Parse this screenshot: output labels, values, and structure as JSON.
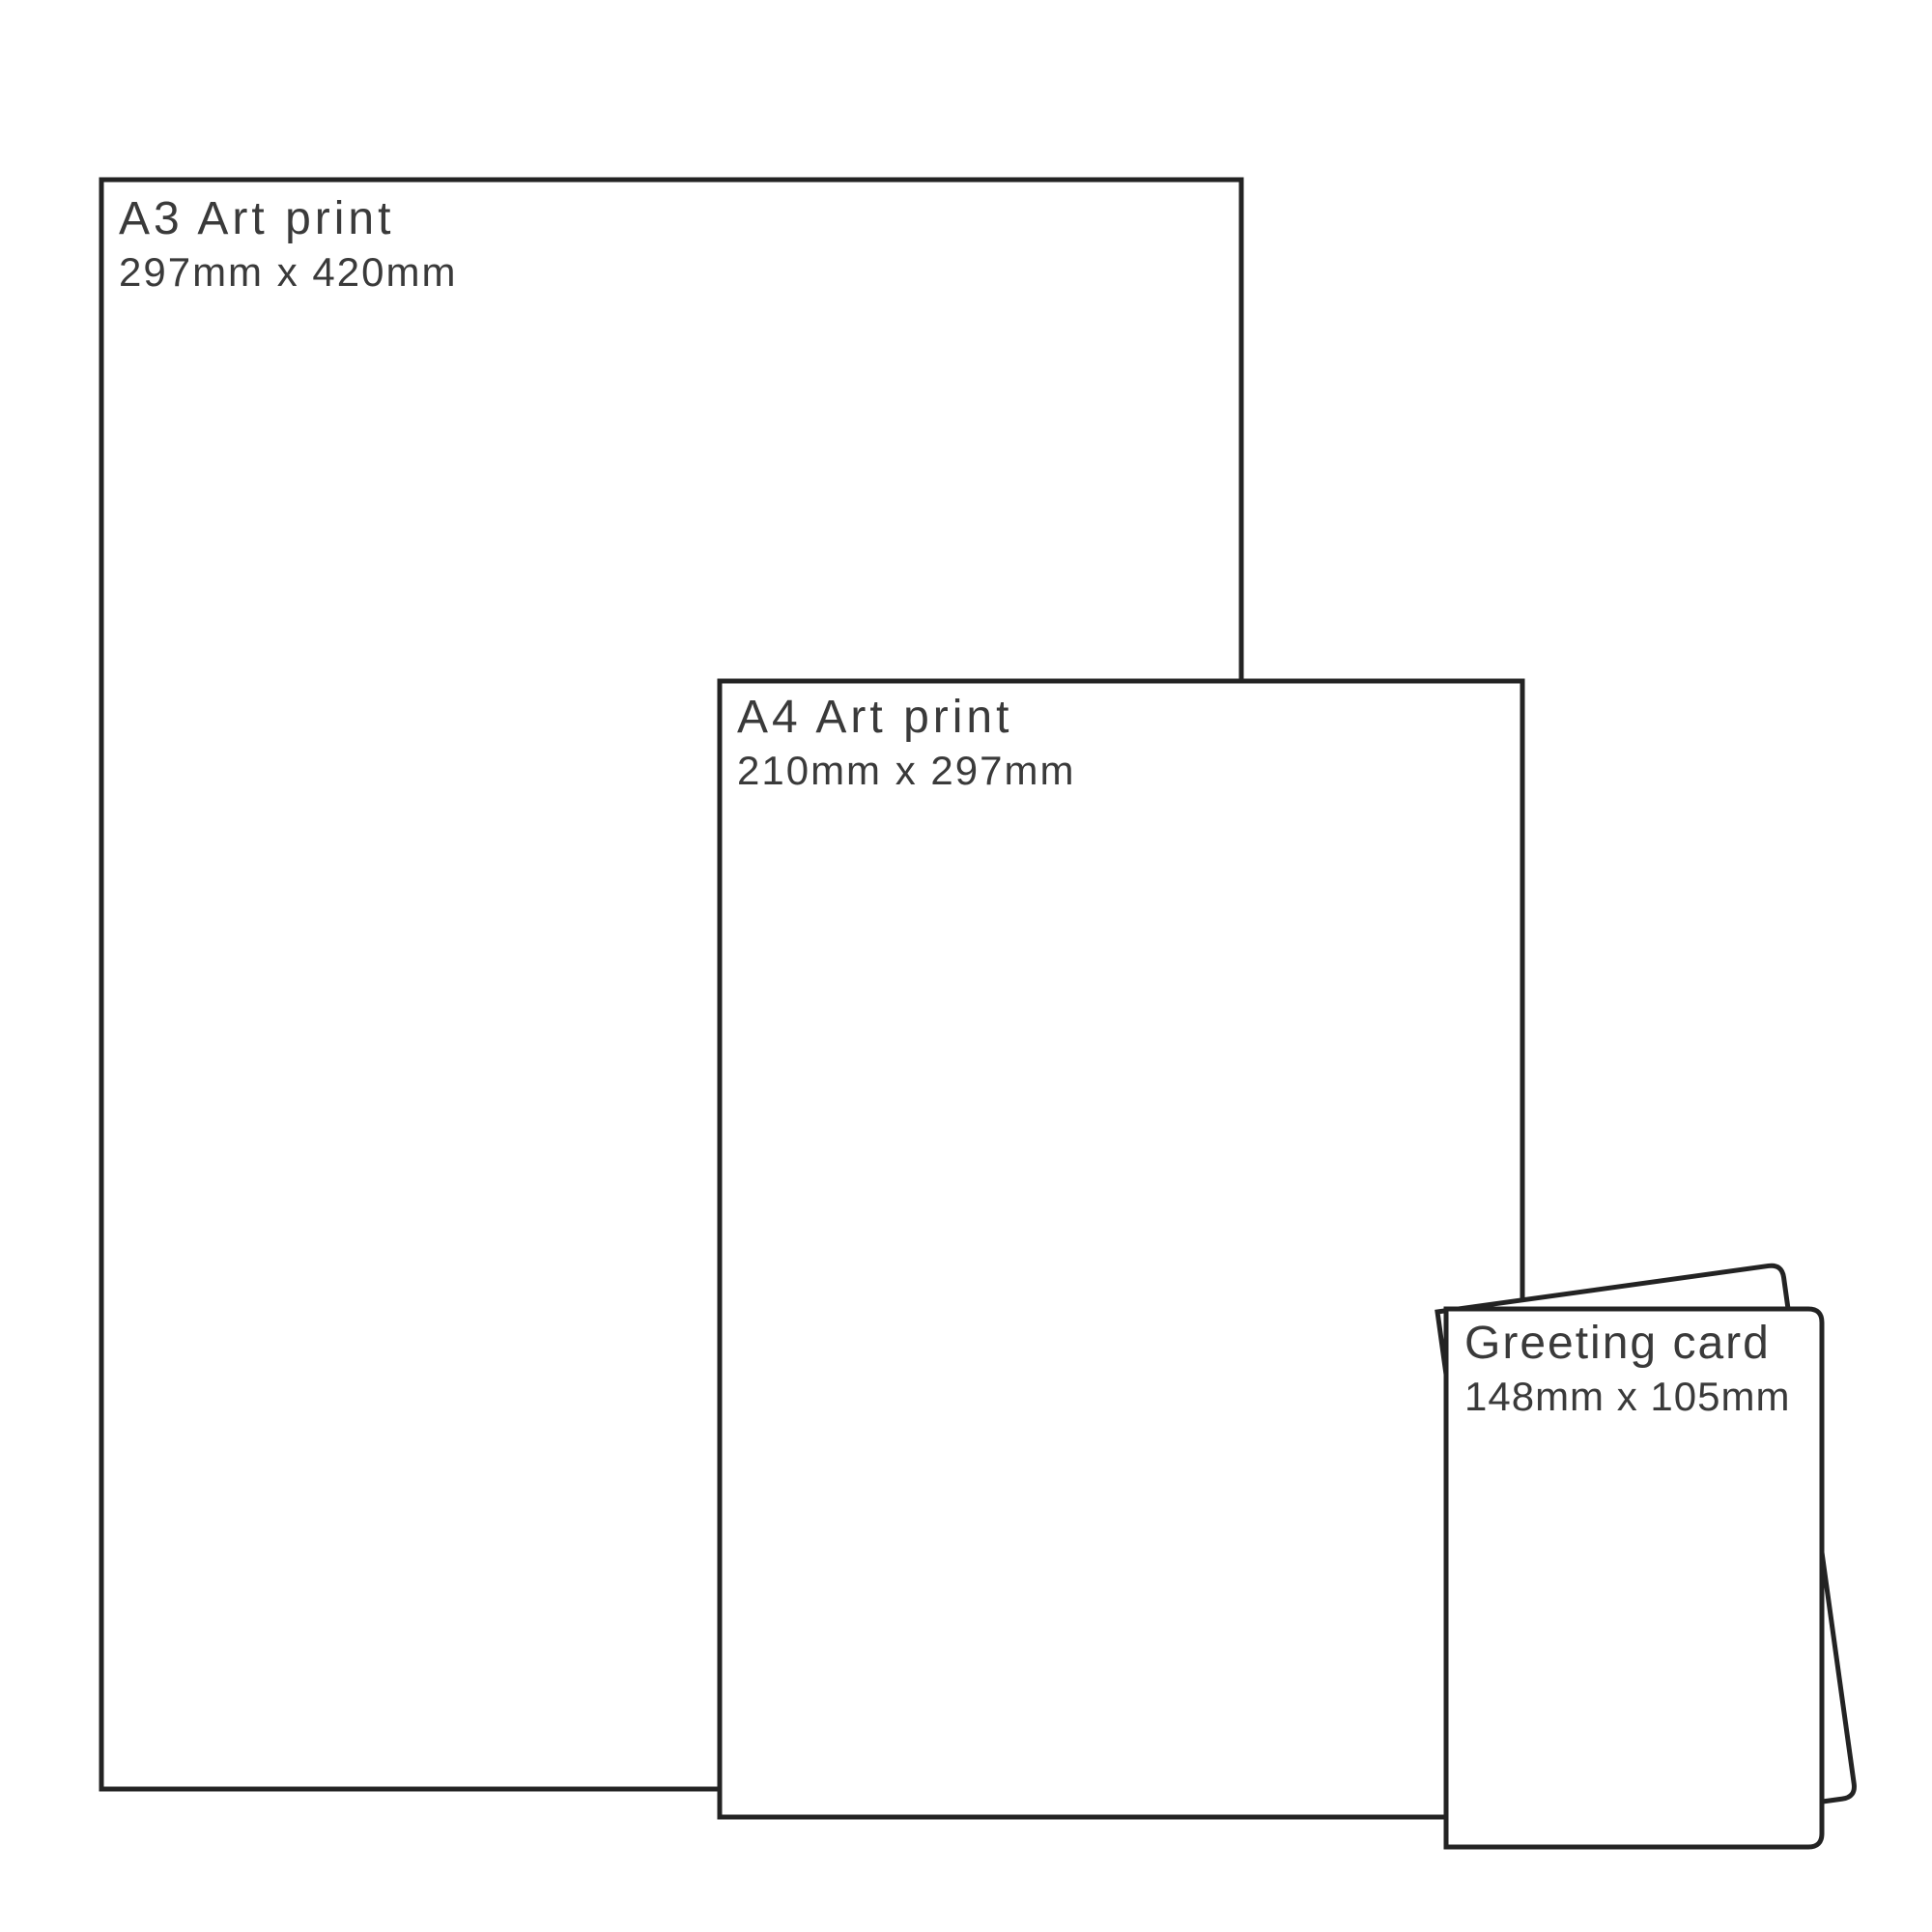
{
  "colors": {
    "background": "#ffffff",
    "outline": "#232323",
    "text": "#3a3a3a"
  },
  "items": [
    {
      "id": "a3-print",
      "title": "A3 Art print",
      "dimensions": "297mm x 420mm"
    },
    {
      "id": "a4-print",
      "title": "A4 Art print",
      "dimensions": "210mm x 297mm"
    },
    {
      "id": "greeting-card",
      "title": "Greeting card",
      "dimensions": "148mm x 105mm"
    }
  ]
}
